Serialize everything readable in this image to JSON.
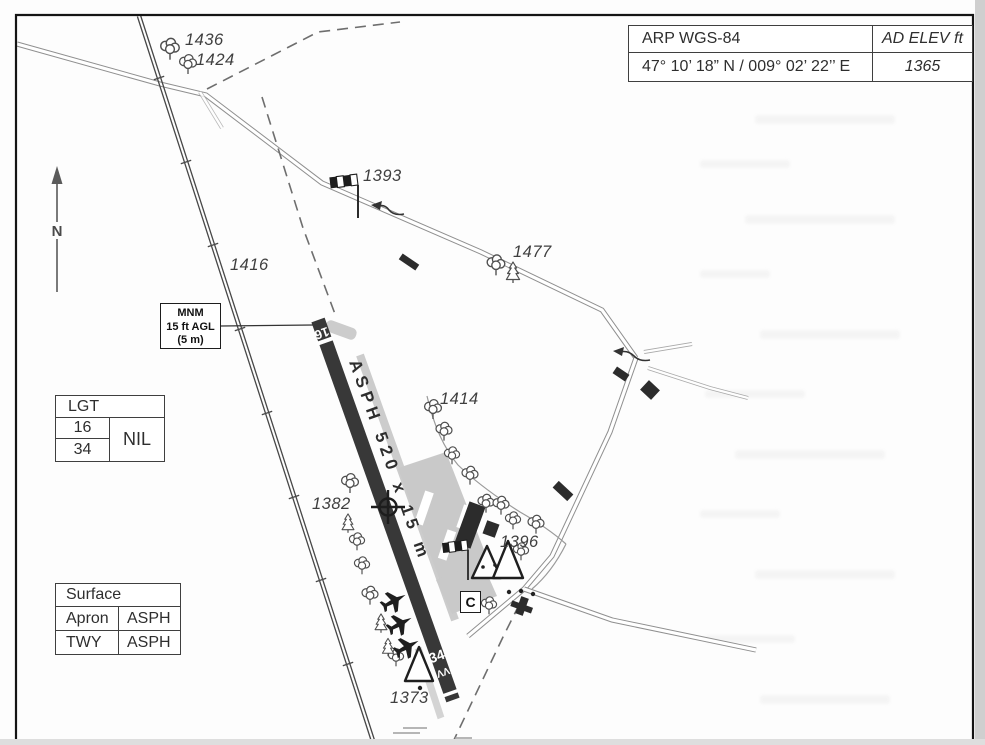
{
  "header_table": {
    "arp_label": "ARP WGS-84",
    "elev_label": "AD ELEV ft",
    "coordinates": "47° 10’ 18” N / 009° 02’ 22’’ E",
    "elevation_value": "1365"
  },
  "north_arrow": {
    "label": "N"
  },
  "mnm_box": {
    "line1": "MNM",
    "line2": "15 ft AGL",
    "line3": "(5 m)"
  },
  "lgt_table": {
    "title": "LGT",
    "rwy_16": "16",
    "rwy_34": "34",
    "value": "NIL"
  },
  "surface_table": {
    "title": "Surface",
    "row1_label": "Apron",
    "row1_value": "ASPH",
    "row2_label": "TWY",
    "row2_value": "ASPH"
  },
  "runway": {
    "rwy16_label": "16",
    "rwy34_label": "34",
    "surface_dims": "ASPH 520 x 15 m",
    "chevrons": "ΛΛ"
  },
  "signal_area": {
    "label": "C"
  },
  "spots": {
    "e1436": "1436",
    "e1424": "1424",
    "e1393": "1393",
    "e1477": "1477",
    "e1416": "1416",
    "e1414": "1414",
    "e1382": "1382",
    "e1396": "1396",
    "e1373": "1373"
  },
  "colors": {
    "runway": "#383838",
    "building": "#2c2c2c",
    "taxiway": "#c9c9c9",
    "line": "#555555",
    "frame": "#141414"
  }
}
